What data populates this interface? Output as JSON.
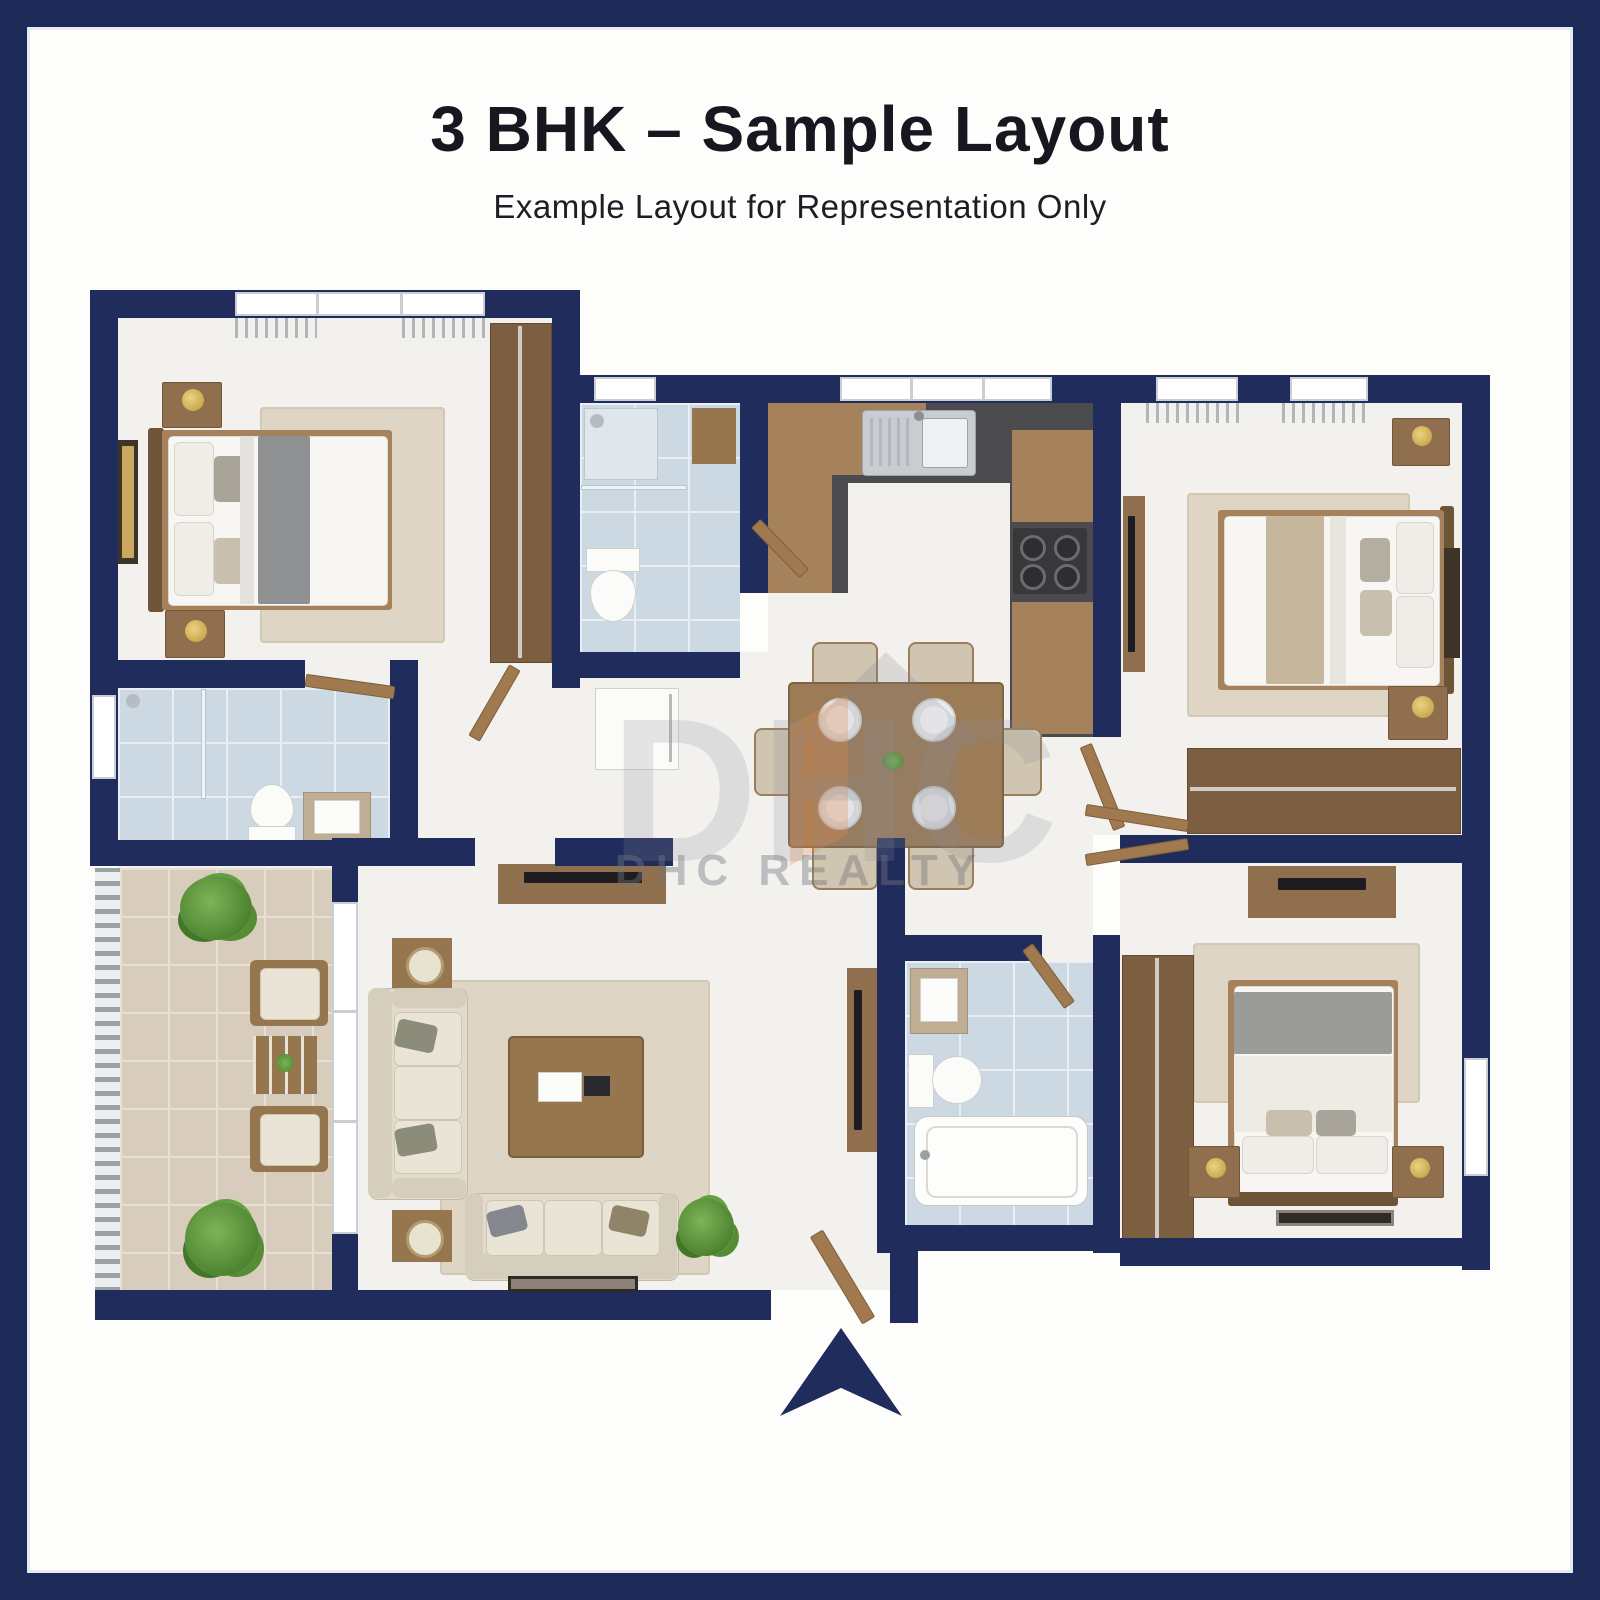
{
  "header": {
    "title": "3 BHK – Sample Layout",
    "subtitle": "Example Layout for Representation Only"
  },
  "watermark": {
    "logo_text": "DHC",
    "brand_text": "DHC REALTY"
  },
  "entrance": {
    "arrow_icon": "entrance-arrow-up"
  },
  "colors": {
    "frame_navy": "#1d2a58",
    "wall_navy": "#1f2c5c",
    "bath_tile_blue": "#ccd9e2",
    "balcony_tile_beige": "#d8ccbc",
    "wood": "#a5825c",
    "counter_dark": "#4b4b4e",
    "rug_beige": "#ded5c4",
    "plant_green": "#4d8330",
    "lamp_gold": "#bd9838",
    "watermark_gray": "#8e8e96",
    "watermark_orange": "#e08b4f"
  }
}
